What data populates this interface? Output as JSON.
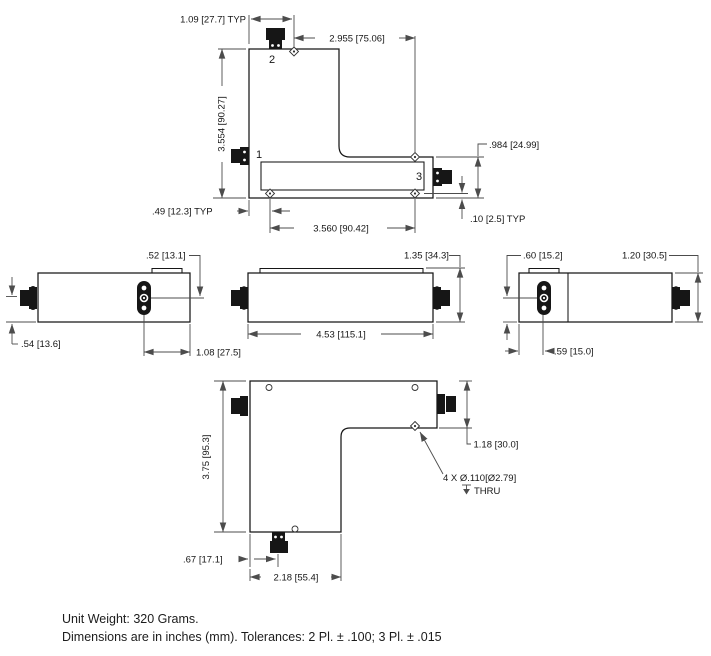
{
  "colors": {
    "line": "#161616",
    "dim": "#4c4c4c",
    "background": "#ffffff"
  },
  "top_view": {
    "port1": "1",
    "port2": "2",
    "port3": "3",
    "dim_port_spacing_typ": "1.09 [27.7] TYP",
    "dim_top_width": "2.955 [75.06]",
    "dim_overall_height": "3.554 [90.27]",
    "dim_bar_height": ".984 [24.99]",
    "dim_hole_edge_typ": ".49 [12.3] TYP",
    "dim_hole_spacing": "3.560 [90.42]",
    "dim_hole_offset_typ": ".10 [2.5] TYP"
  },
  "left_side_view": {
    "dim_lid_offset": ".52 [13.1]",
    "dim_connector_height": ".54 [13.6]",
    "dim_connector_offset": "1.08 [27.5]"
  },
  "front_side_view": {
    "dim_overall_height": "1.35 [34.3]",
    "dim_overall_length": "4.53 [115.1]"
  },
  "right_side_view": {
    "dim_connector_center": ".60 [15.2]",
    "dim_body_height": "1.20 [30.5]",
    "dim_connector_offset": ".59 [15.0]"
  },
  "bottom_view": {
    "dim_overall_height": "3.75 [95.3]",
    "dim_bar_height": "1.18 [30.0]",
    "hole_callout": "4 X Ø.110[Ø2.79]",
    "hole_depth_note": "THRU",
    "dim_connector_offset": ".67 [17.1]",
    "dim_limb_width": "2.18 [55.4]"
  },
  "notes": {
    "unit_weight": "Unit Weight: 320 Grams.",
    "tolerances": "Dimensions are in inches (mm). Tolerances: 2 Pl. ± .100; 3 Pl. ± .015"
  }
}
